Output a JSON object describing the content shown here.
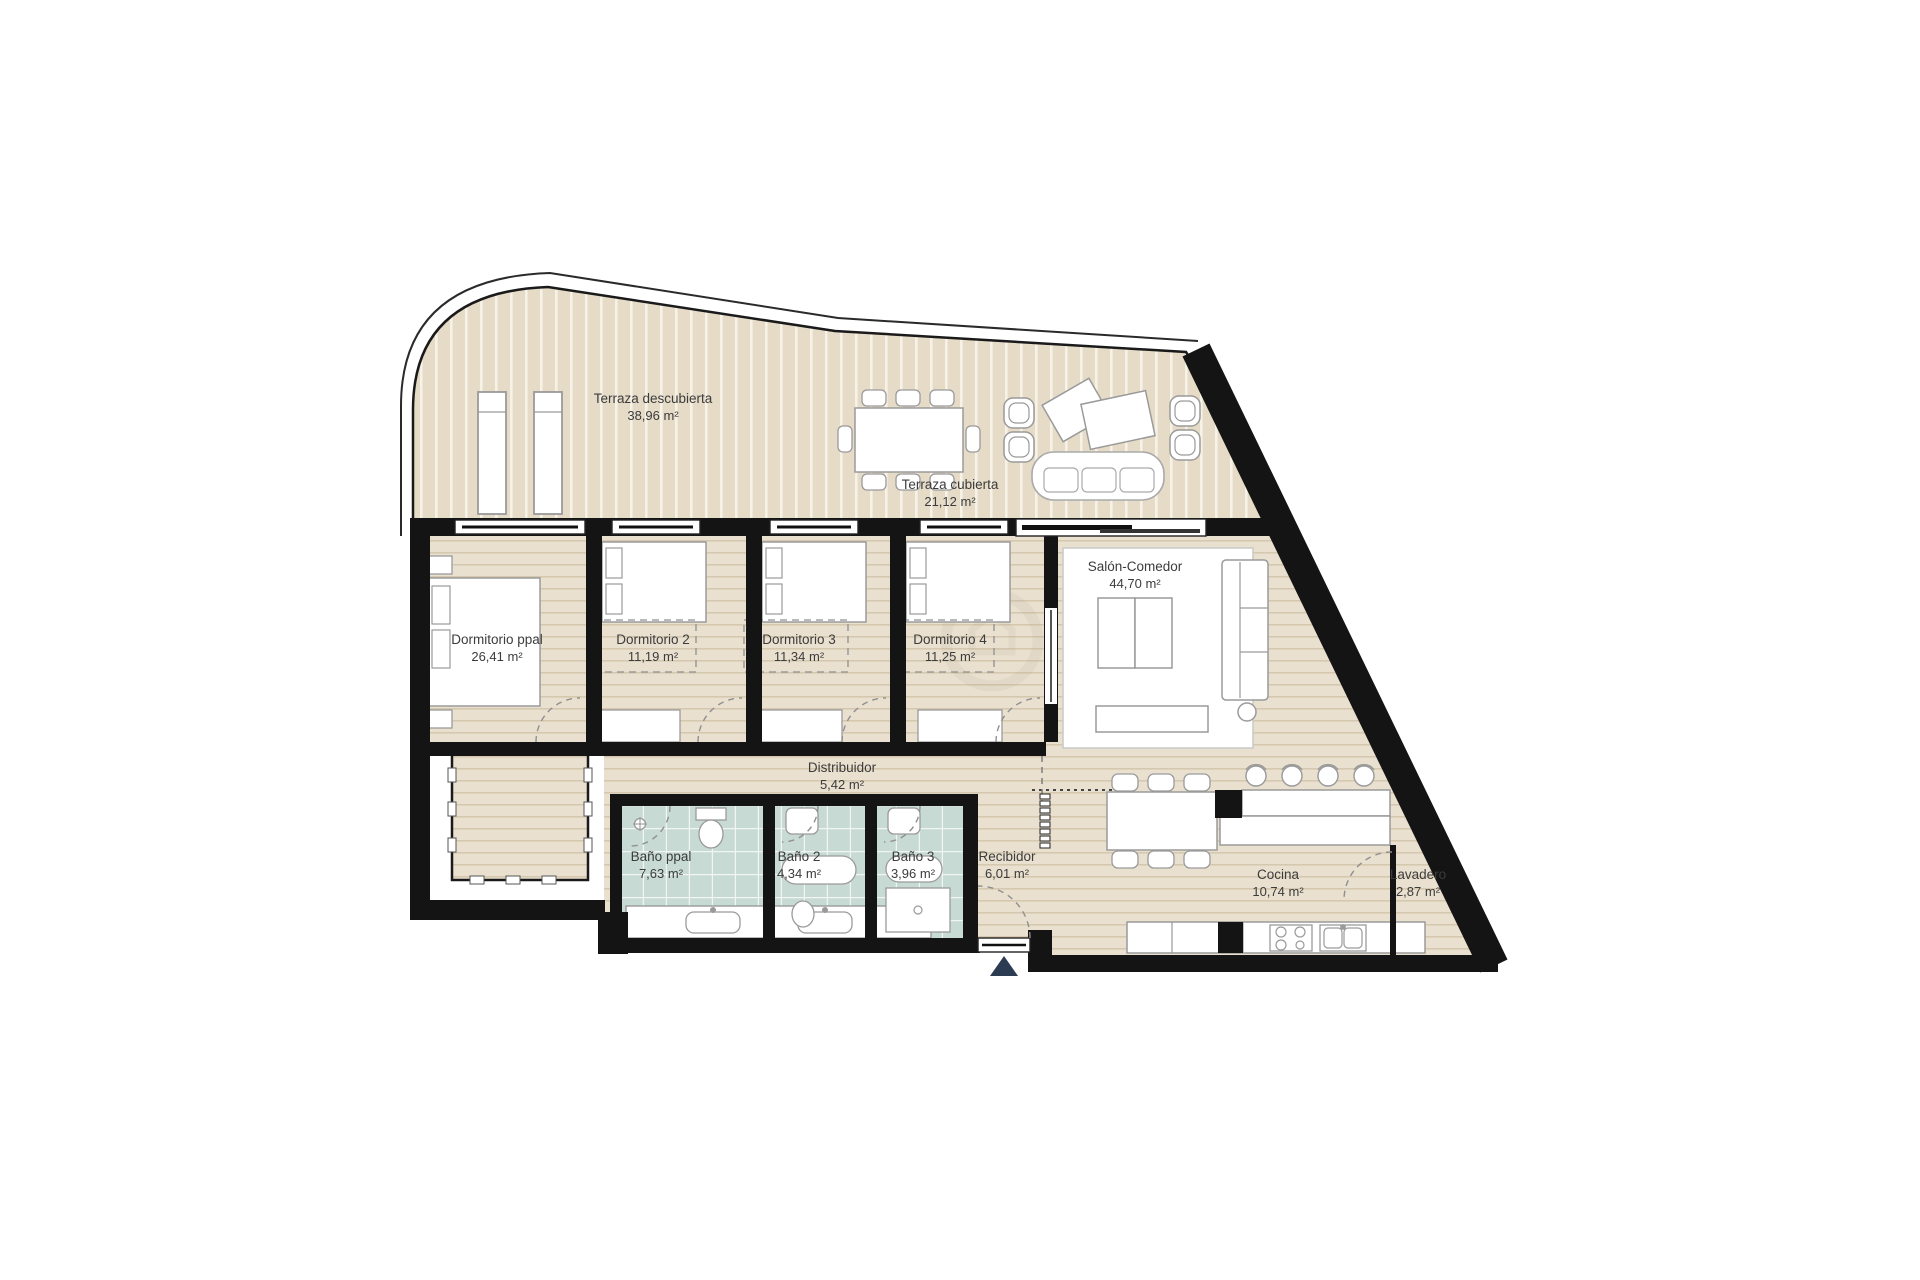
{
  "plan": {
    "type": "apartment-floor-plan",
    "language": "es",
    "colors": {
      "wall": "#141414",
      "wood_floor": "#e9e0cf",
      "deck": "#e5dbc7",
      "bath_tile": "#c7dad4",
      "furniture_outline": "#9a9a9a",
      "entrance_arrow": "#2a3b52"
    }
  },
  "rooms": [
    {
      "id": "terraza-descubierta",
      "name": "Terraza descubierta",
      "area": "38,96 m²"
    },
    {
      "id": "terraza-cubierta",
      "name": "Terraza cubierta",
      "area": "21,12 m²"
    },
    {
      "id": "dormitorio-ppal",
      "name": "Dormitorio ppal",
      "area": "26,41 m²"
    },
    {
      "id": "dormitorio-2",
      "name": "Dormitorio 2",
      "area": "11,19 m²"
    },
    {
      "id": "dormitorio-3",
      "name": "Dormitorio 3",
      "area": "11,34 m²"
    },
    {
      "id": "dormitorio-4",
      "name": "Dormitorio 4",
      "area": "11,25 m²"
    },
    {
      "id": "salon-comedor",
      "name": "Salón-Comedor",
      "area": "44,70 m²"
    },
    {
      "id": "distribuidor",
      "name": "Distribuidor",
      "area": "5,42 m²"
    },
    {
      "id": "bano-ppal",
      "name": "Baño ppal",
      "area": "7,63 m²"
    },
    {
      "id": "bano-2",
      "name": "Baño 2",
      "area": "4,34 m²"
    },
    {
      "id": "bano-3",
      "name": "Baño 3",
      "area": "3,96 m²"
    },
    {
      "id": "recibidor",
      "name": "Recibidor",
      "area": "6,01 m²"
    },
    {
      "id": "cocina",
      "name": "Cocina",
      "area": "10,74 m²"
    },
    {
      "id": "lavadero",
      "name": "Lavadero",
      "area": "2,87 m²"
    }
  ]
}
